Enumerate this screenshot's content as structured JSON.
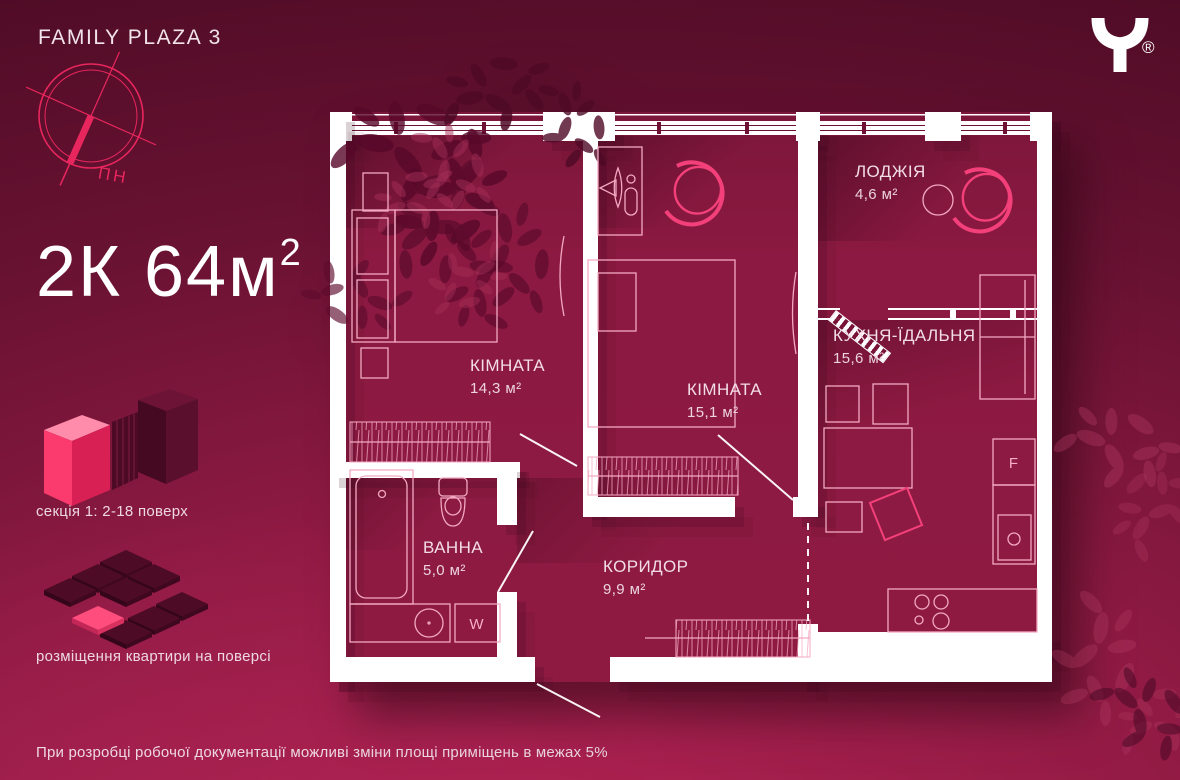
{
  "brand": {
    "project_title": "FAMILY PLAZA 3",
    "registered_mark": "®"
  },
  "compass": {
    "north_label": "ПН"
  },
  "headline": {
    "value": "2К 64м",
    "sup": "2"
  },
  "legend": {
    "section_caption": "секція 1: 2-18 поверх",
    "placement_caption": "розміщення квартири на поверсі"
  },
  "rooms": [
    {
      "id": "bedroom-1",
      "name": "КІМНАТА",
      "area": "14,3 м²"
    },
    {
      "id": "bedroom-2",
      "name": "КІМНАТА",
      "area": "15,1 м²"
    },
    {
      "id": "loggia",
      "name": "ЛОДЖІЯ",
      "area": "4,6 м²"
    },
    {
      "id": "kitchen-dining",
      "name": "КУХНЯ-ЇДАЛЬНЯ",
      "area": "15,6 м²"
    },
    {
      "id": "bathroom",
      "name": "ВАННА",
      "area": "5,0 м²"
    },
    {
      "id": "corridor",
      "name": "КОРИДОР",
      "area": "9,9 м²"
    }
  ],
  "appliance_marks": {
    "washing_machine": "W",
    "fridge": "F"
  },
  "footer": {
    "disclaimer": "При розробці робочої документації можливі зміни площі приміщень в межах 5%"
  },
  "colors": {
    "background_top": "#4c0b24",
    "background_bottom": "#ae2151",
    "floor": "#8c1941",
    "wall": "#ffffff",
    "furniture_line": "#f3a9c2",
    "accent_pink": "#f4407a",
    "compass_pink": "#e8265e"
  }
}
